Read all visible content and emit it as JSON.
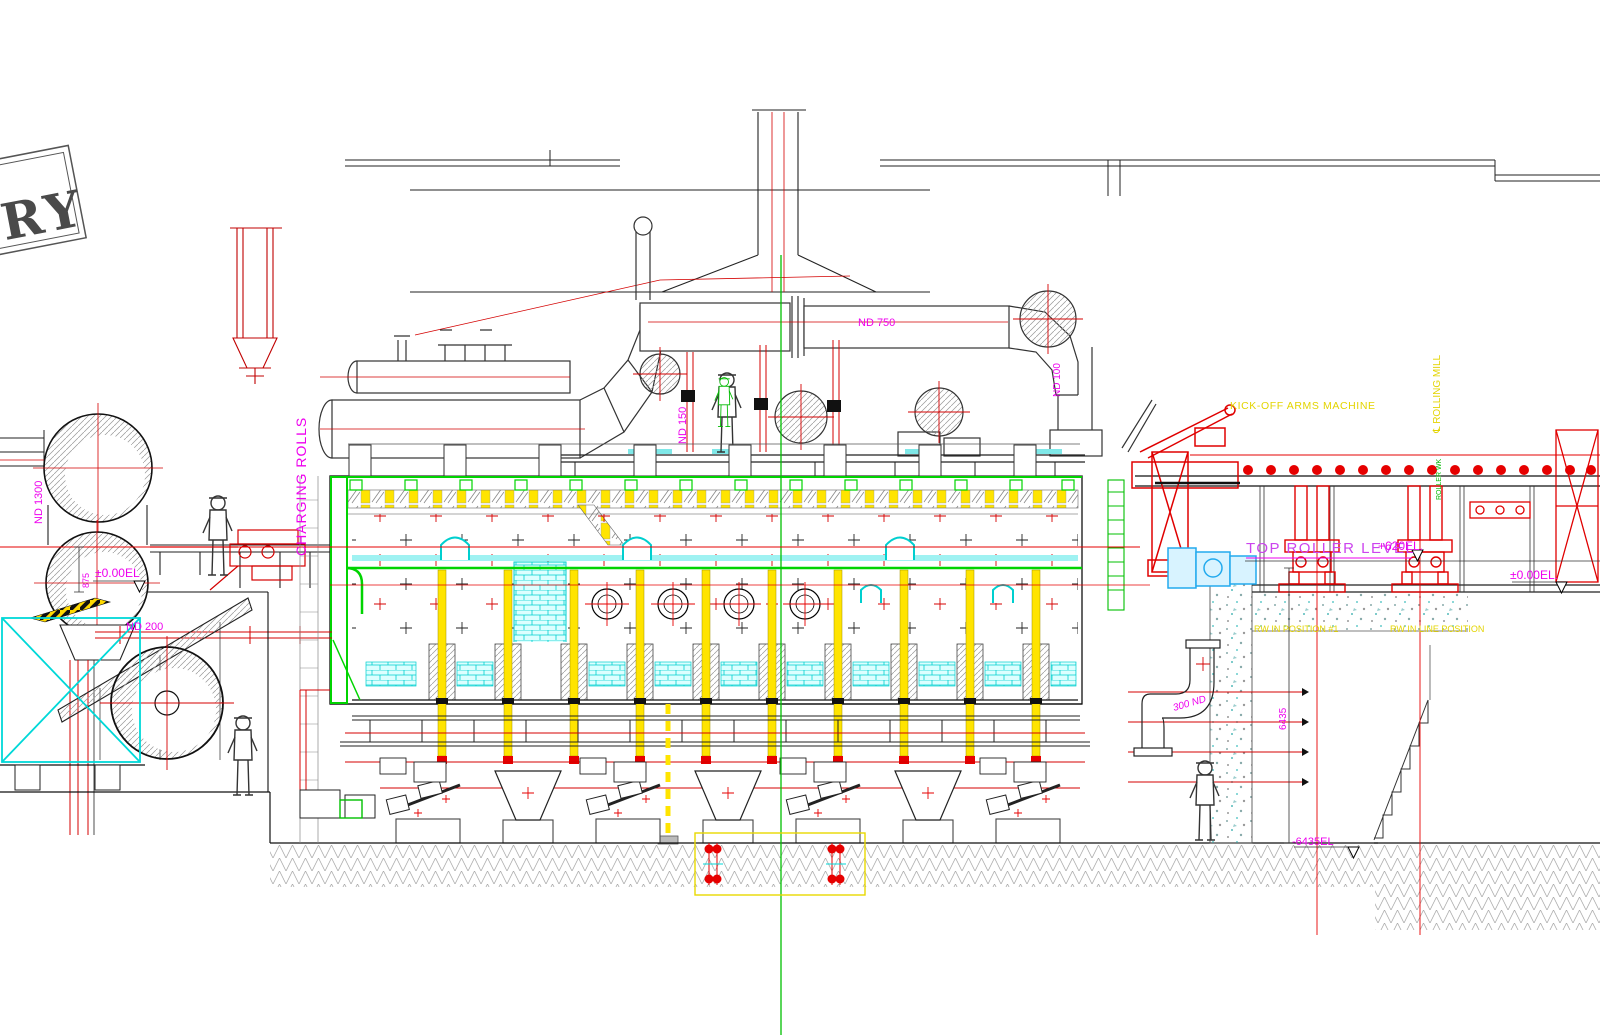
{
  "drawing": {
    "stamp": "RY",
    "labels": {
      "charging_rolls": "CHARGING ROLLS",
      "kick_off": "KICK-OFF ARMS MACHINE",
      "rolling_mill": "℄ ROLLING MILL",
      "roller_wk": "ROLLER WK",
      "top_roller_level": "TOP ROLLER LEVEL",
      "rw_position_1": "RW IN POSITION #1",
      "rw_line_position": "RW IN LINE POSITION"
    },
    "pipes": {
      "nd750": "ND 750",
      "nd1300": "ND 1300",
      "nd200": "ND 200",
      "nd150": "ND 150",
      "nd100": "ND 100",
      "nd300": "300 ND"
    },
    "elevations": {
      "zero_left": "±0.00EL",
      "zero_right": "±0.00EL.",
      "top_roller": "+620EL.",
      "pit": "-6435EL"
    },
    "dims": {
      "d875": "875",
      "d6435": "6435"
    },
    "colors": {
      "magenta": "#EE00EE",
      "yellow": "#EFE000",
      "green": "#00CC00",
      "cyan": "#00E0E0",
      "red": "#E60000",
      "black": "#000000",
      "gray": "#8C8C8C"
    }
  }
}
